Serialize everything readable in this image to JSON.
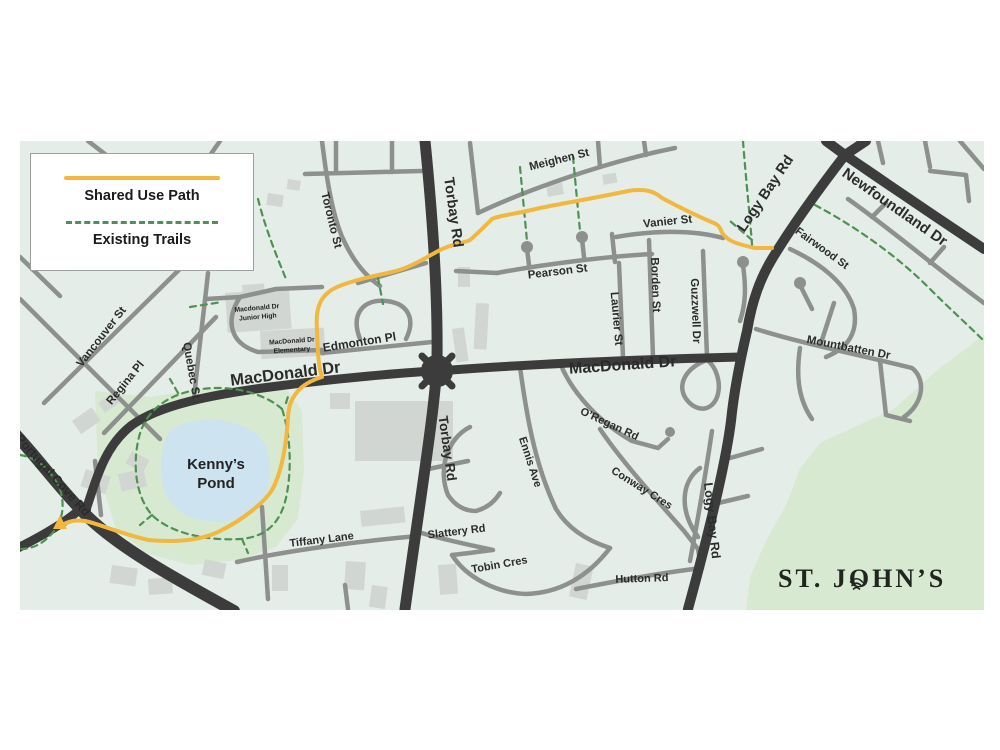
{
  "colors": {
    "map_bg": "#e4ede7",
    "park": "#d8e9d1",
    "pond": "#cde3f0",
    "road_minor": "#8d908d",
    "road_major": "#3c3c3c",
    "building": "#d2d6d2",
    "shared_path": "#f1b73f",
    "trail": "#4e9153",
    "label": "#2b2b2b",
    "legend_border": "#9aa09e",
    "wordmark": "#20251f"
  },
  "map": {
    "legend": {
      "shared_use_path_label": "Shared Use Path",
      "existing_trails_label": "Existing Trails"
    },
    "streets": {
      "meighen_st": "Meighen St",
      "torbay_rd": "Torbay Rd",
      "toronto_st": "Toronto St",
      "vanier_st": "Vanier St",
      "pearson_st": "Pearson St",
      "borden_st": "Borden St",
      "laurier_st": "Laurier St",
      "guzzwell_dr": "Guzzwell Dr",
      "logy_bay_rd": "Logy Bay Rd",
      "newfoundland_dr": "Newfoundland Dr",
      "fairwood_st": "Fairwood St",
      "mountbatten_dr": "Mountbatten Dr",
      "vancouver_st": "Vancouver St",
      "regina_pl": "Regina Pl",
      "quebec_st": "Quebec St",
      "macdonald_dr": "MacDonald Dr",
      "edmonton_pl": "Edmonton Pl",
      "portugal_cove_rd": "Portugal Cove Rd",
      "oregan_rd": "O’Regan Rd",
      "ennis_ave": "Ennis Ave",
      "conway_cres": "Conway Cres",
      "tiffany_lane": "Tiffany Lane",
      "slattery_rd": "Slattery Rd",
      "tobin_cres": "Tobin Cres",
      "hutton_rd": "Hutton Rd"
    },
    "places": {
      "pond_line1": "Kenny’s",
      "pond_line2": "Pond",
      "junior_high_line1": "Macdonald Dr",
      "junior_high_line2": "Junior High",
      "elementary_line1": "MacDonald Dr",
      "elementary_line2": "Elementary"
    },
    "branding": {
      "city": "ST. JOHN’S"
    }
  }
}
